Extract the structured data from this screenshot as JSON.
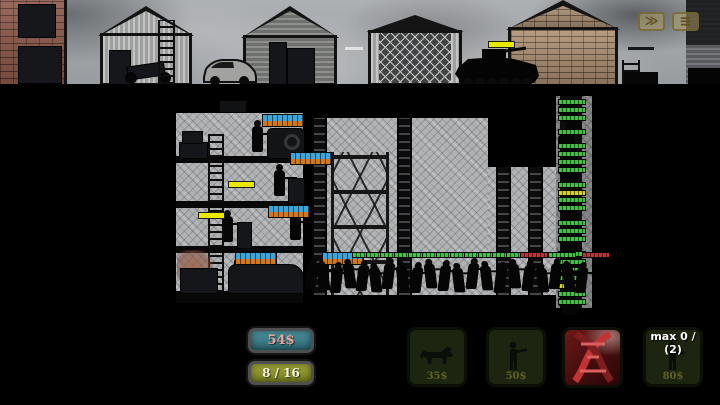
{
  "hud": {
    "speed_button": {
      "glyph": "≫"
    },
    "menu_button": {
      "glyph": "≡"
    },
    "money_label": "54$",
    "ammo_label": "8 / 16",
    "shop": {
      "max_counter": "max 0 / (2)",
      "buttons": [
        {
          "id": "dog-unit",
          "price": "35$"
        },
        {
          "id": "soldier-unit",
          "price": "50$"
        },
        {
          "id": "dna-upgrade",
          "price": ""
        },
        {
          "id": "elite-soldier-unit",
          "price": "80$"
        }
      ]
    }
  },
  "colors": {
    "money_text": "#eea396",
    "ammo_text": "#f2f2e6",
    "money_panel": "#3d8290",
    "ammo_panel": "#8f941f",
    "health_friendly_top": "#3fa4d8",
    "health_friendly_bottom": "#d0781c",
    "health_enemy": "#3ec43e",
    "health_enemy_low": "#c43232",
    "health_enemy_ammo": "#d8d800",
    "ammo_bar": "#e8e800"
  },
  "scene": {
    "defender_bars": [
      {
        "x": 262,
        "y": 114
      },
      {
        "x": 290,
        "y": 152
      },
      {
        "x": 268,
        "y": 205
      },
      {
        "x": 235,
        "y": 252
      },
      {
        "x": 322,
        "y": 252
      }
    ],
    "ammo_bars": [
      {
        "x": 228,
        "y": 181
      },
      {
        "x": 198,
        "y": 212
      }
    ],
    "tank_bar": {
      "x": 488,
      "y": 41,
      "w": 25
    },
    "surface_bars": [
      {
        "x": 345,
        "y": 47,
        "w": 18,
        "color": "#e2e2e2"
      },
      {
        "x": 628,
        "y": 47,
        "w": 26,
        "color": "#16181a"
      }
    ],
    "tower": {
      "x": 558,
      "top": 96,
      "bottom": 308,
      "bar_ys": [
        99,
        107,
        115,
        129,
        143,
        151,
        159,
        167,
        182,
        197,
        205,
        220,
        228,
        236,
        251,
        259,
        267,
        275,
        291,
        299
      ],
      "yellow_bar_ys": [
        190,
        283
      ]
    },
    "horde": {
      "bar_y": 252,
      "bar_xs": [
        352,
        366,
        380,
        394,
        408,
        422,
        436,
        450,
        464,
        478,
        492,
        506,
        534,
        548
      ],
      "red_bar_xs": [
        520,
        582
      ],
      "zombie_xs": [
        306,
        318,
        331,
        344,
        357,
        370,
        383,
        397,
        411,
        425,
        439,
        453,
        467,
        481,
        495,
        509,
        523,
        537,
        550,
        563,
        576
      ]
    }
  }
}
